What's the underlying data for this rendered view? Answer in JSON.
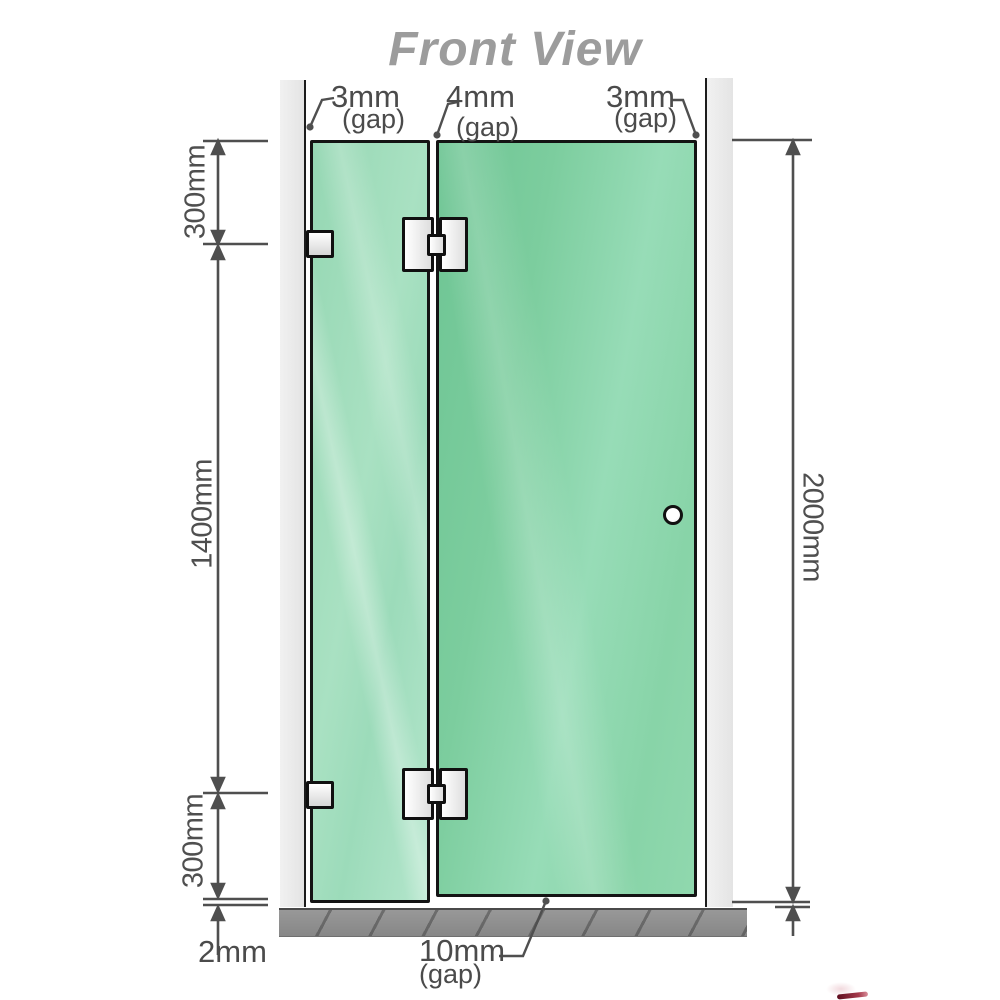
{
  "title": "Front View",
  "measurements": {
    "top_gaps": [
      {
        "value": "3mm",
        "unit": "(gap)"
      },
      {
        "value": "4mm",
        "unit": "(gap)"
      },
      {
        "value": "3mm",
        "unit": "(gap)"
      }
    ],
    "left": {
      "top_segment": "300mm",
      "middle_segment": "1400mm",
      "bottom_segment": "300mm",
      "floor_gap": "2mm"
    },
    "right": {
      "total_height": "2000mm"
    },
    "bottom": {
      "door_floor_gap_value": "10mm",
      "door_floor_gap_unit": "(gap)"
    }
  },
  "colors": {
    "title_gray": "#9c9c9c",
    "dimension_gray": "#4f4f4f",
    "wall_gray": "#eaeaea",
    "glass_fixed_green": "#a5dfc0",
    "glass_door_green": "#7ccd9e",
    "floor_gray": "#8f8f8f",
    "hardware_white": "#f5f5f5",
    "accent_red": "#7a0f20"
  }
}
